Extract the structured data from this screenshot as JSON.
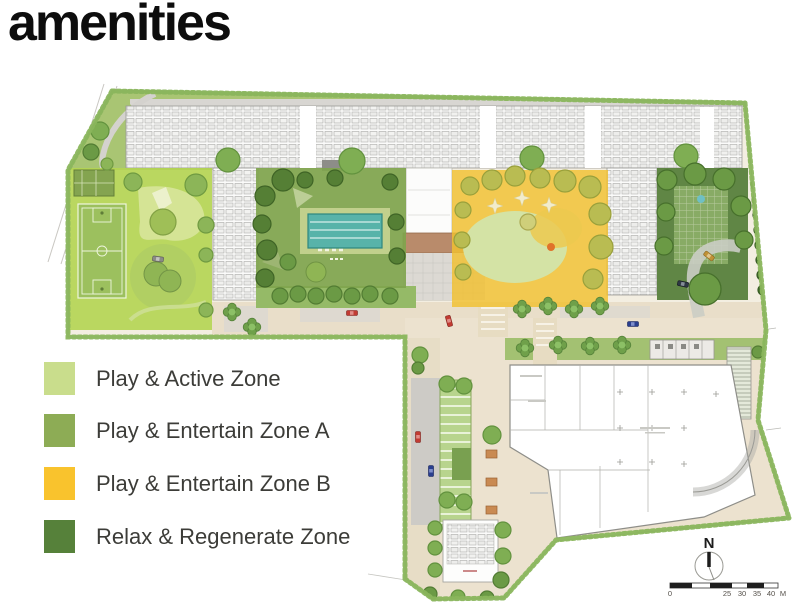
{
  "title": {
    "text": "amenities"
  },
  "legend": {
    "items": [
      {
        "label": "Play & Active Zone",
        "color": "#c9dd8c"
      },
      {
        "label": "Play & Entertain Zone A",
        "color": "#8dac55"
      },
      {
        "label": "Play & Entertain Zone B",
        "color": "#f9c32d"
      },
      {
        "label": "Relax & Regenerate Zone",
        "color": "#56813a"
      }
    ]
  },
  "map": {
    "compass": {
      "label": "N"
    },
    "scale_bar": {
      "labels": [
        "0",
        "25",
        "30",
        "35",
        "40",
        "M"
      ]
    },
    "zone_colors": {
      "play_active": "#b4d452",
      "entertain_a": "#7fa44d",
      "entertain_b": "#f2c130",
      "relax": "#56803a"
    }
  }
}
